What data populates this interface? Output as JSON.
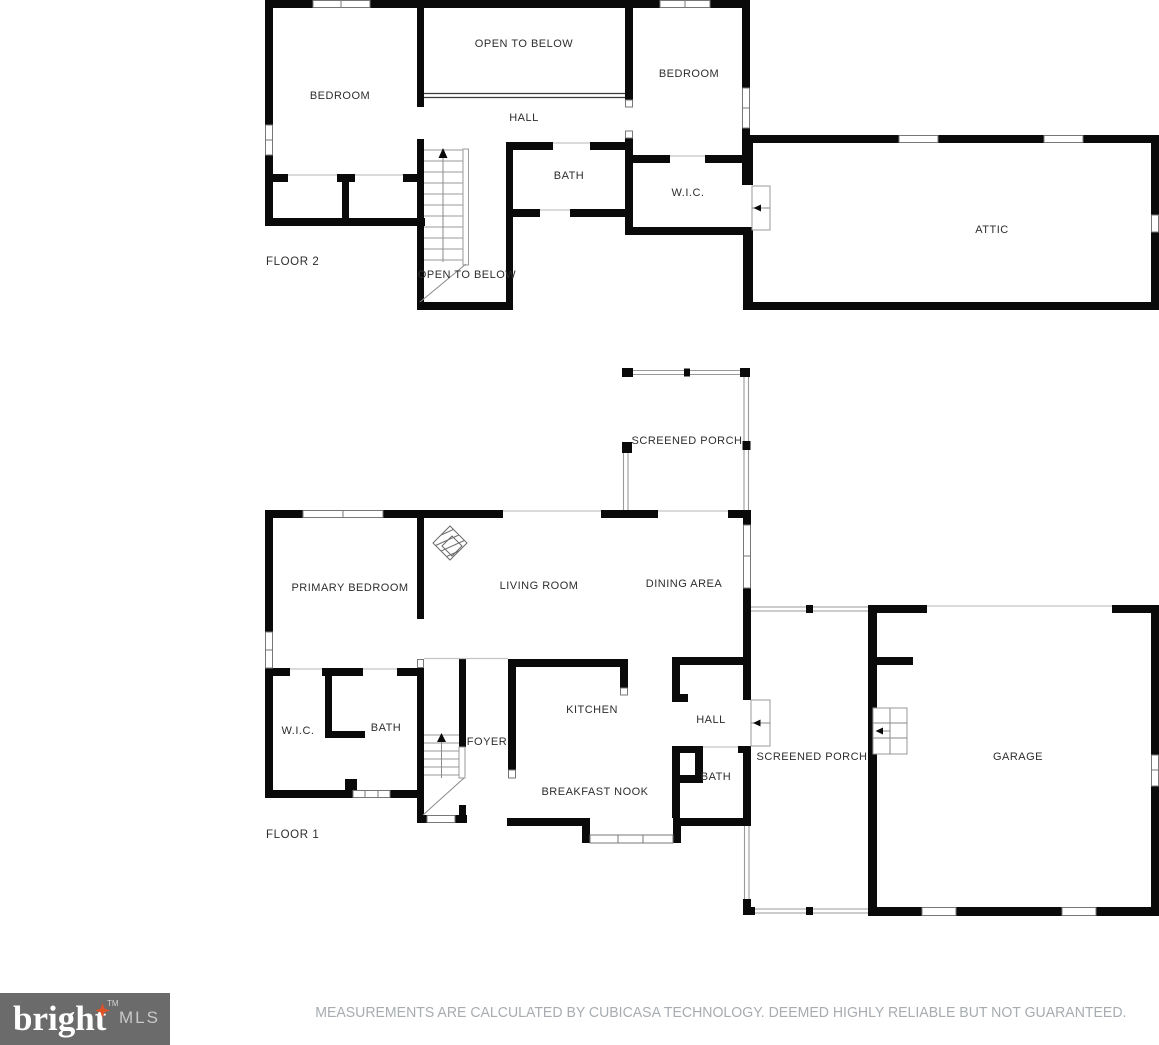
{
  "floor2": {
    "title": "FLOOR 2",
    "bedroom_left": "BEDROOM",
    "open_to_below": "OPEN TO BELOW",
    "hall": "HALL",
    "bedroom_right": "BEDROOM",
    "bath": "BATH",
    "wic": "W.I.C.",
    "attic": "ATTIC",
    "stairs_open_to_below": "OPEN TO BELOW"
  },
  "floor1": {
    "title": "FLOOR 1",
    "screened_porch_top": "SCREENED PORCH",
    "primary_bedroom": "PRIMARY BEDROOM",
    "living_room": "LIVING ROOM",
    "dining_area": "DINING AREA",
    "wic": "W.I.C.",
    "bath": "BATH",
    "foyer": "FOYER",
    "kitchen": "KITCHEN",
    "hall": "HALL",
    "bath2": "BATH",
    "breakfast_nook": "BREAKFAST NOOK",
    "screened_porch_side": "SCREENED PORCH",
    "garage": "GARAGE"
  },
  "footer": {
    "brand": "bright",
    "brand_suffix": "MLS",
    "trademark": "TM",
    "disclaimer": "MEASUREMENTS ARE CALCULATED BY CUBICASA TECHNOLOGY. DEEMED HIGHLY RELIABLE BUT NOT GUARANTEED."
  },
  "colors": {
    "wall": "#0a0a0a",
    "window_border": "#777777",
    "footer_bg": "#6b6b6b",
    "star_accent": "#dd5227",
    "disclaimer_text": "#a7acb0",
    "label_text": "#2d2d2d"
  }
}
